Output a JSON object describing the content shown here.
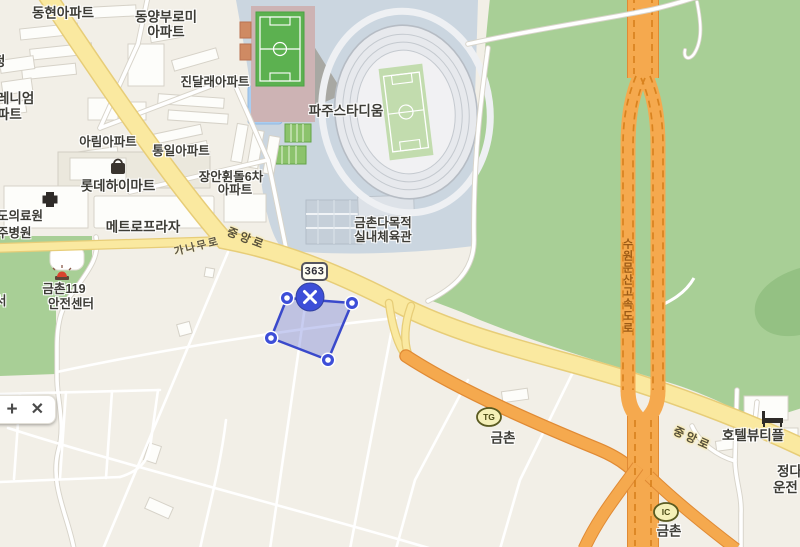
{
  "map": {
    "place_labels": {
      "donghyun": "동현아파트",
      "dongyang_l1": "동양부로미",
      "dongyang_l2": "아파트",
      "jindalrae": "진달래아파트",
      "jeong_partial": "정",
      "millennium_l1": "레니엄",
      "millennium_l2": "파트",
      "arim": "아림아파트",
      "tongil": "통일아파트",
      "lotte": "롯데하이마트",
      "jangan_l1": "장안휜돌6차",
      "jangan_l2": "아파트",
      "hospital_l1": "도의료원",
      "hospital_l2": "주병원",
      "metro": "메트로프라자",
      "fire_l1": "금촌119",
      "fire_l2": "안전센터",
      "seo_partial": "서",
      "stadium": "파주스타디움",
      "gym_l1": "금촌다목적",
      "gym_l2": "실내체육관",
      "tg_town": "금촌",
      "ic_town": "금촌",
      "hotel": "호텔뷰티플",
      "jeongda_partial": "정다",
      "unjeon_partial": "운전"
    },
    "road_labels": {
      "jungang_nw": "중앙로",
      "ganamu": "가나무로",
      "jungang_se": "중앙로",
      "expressway": "수원문산고속도로"
    },
    "badges": {
      "route": "363",
      "tollgate": "TG",
      "interchange": "IC"
    },
    "toolbar": {
      "zoom_in": "+",
      "close": "✕"
    },
    "icons": {
      "lotte_mart": "shopping-bag-icon",
      "hospital": "hospital-cross-icon",
      "fire_station": "siren-icon",
      "hotel": "bed-icon",
      "polygon_delete": "close-icon",
      "control_plus": "plus-icon",
      "control_close": "close-icon"
    },
    "selection": {
      "vertex_count": 4
    },
    "colors": {
      "base": "#f2efe7",
      "park_green": "#a8cf96",
      "park_green_dark": "#94c183",
      "stadium_zone": "#cbd6e0",
      "water": "#a9cdf0",
      "road_yellow": "#fae9a0",
      "road_yellow_edge": "#e7cd78",
      "road_orange": "#f5a94e",
      "road_orange_edge": "#e08a34",
      "road_orange_dash": "#d9831f",
      "minor_road": "#ffffff",
      "minor_road_edge": "#d8d4ca",
      "field_green": "#5cb150",
      "selection_fill": "#5d6bd7",
      "selection_stroke": "#3a49cb",
      "handle_blue": "#3d4ed8",
      "label_color": "#3d3c36",
      "expressway_label_color": "#9c5a14"
    }
  }
}
